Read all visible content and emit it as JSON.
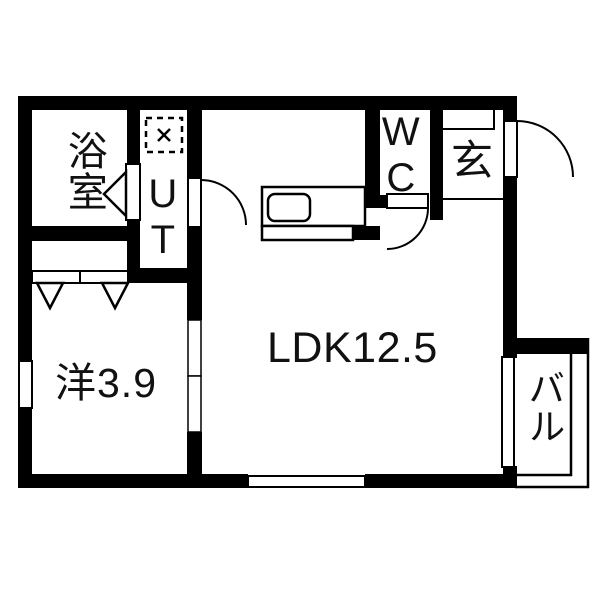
{
  "plan_title": "1LDK apartment floor plan",
  "rooms": {
    "bathroom": {
      "label": "浴室"
    },
    "utility": {
      "label": "UT"
    },
    "toilet": {
      "label": "WC"
    },
    "entrance": {
      "label": "玄"
    },
    "ldk": {
      "label": "LDK12.5"
    },
    "western_room": {
      "label": "洋3.9"
    },
    "balcony": {
      "label": "バル"
    }
  },
  "colors": {
    "wall": "#000000",
    "floor": "#ffffff",
    "line": "#000000"
  }
}
